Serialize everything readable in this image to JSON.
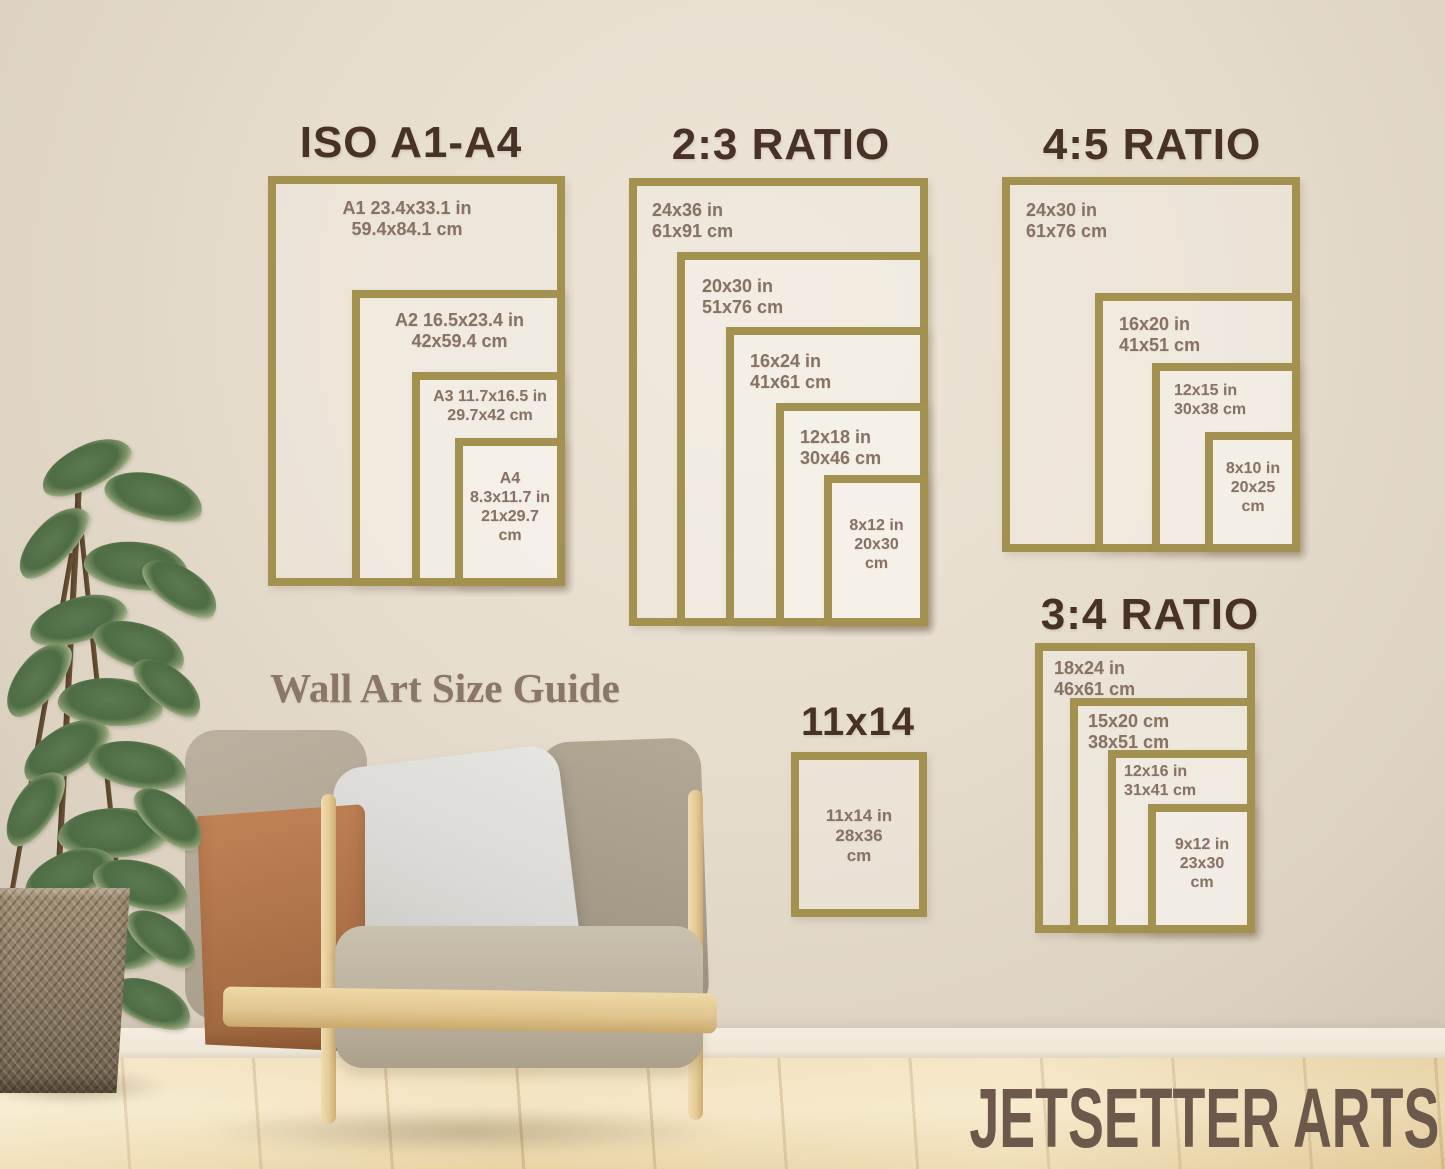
{
  "brand": {
    "watermark": "JETSETTER ARTS"
  },
  "caption": "Wall Art Size Guide",
  "colors": {
    "frame_gold": "#a3914f",
    "title_brown": "#483127",
    "label_brown": "#877264",
    "caption_brown": "#8b7767",
    "watermark_brown": "#6c594b",
    "wall_cream": "#e7decf",
    "floor_wood": "#eedcb4"
  },
  "sections": [
    {
      "title": "ISO A1-A4",
      "boxes": [
        {
          "name": "A1",
          "lines": [
            "A1 23.4x33.1 in",
            "59.4x84.1 cm"
          ]
        },
        {
          "name": "A2",
          "lines": [
            "A2 16.5x23.4 in",
            "42x59.4 cm"
          ]
        },
        {
          "name": "A3",
          "lines": [
            "A3 11.7x16.5 in",
            "29.7x42 cm"
          ]
        },
        {
          "name": "A4",
          "lines": [
            "A4",
            "8.3x11.7 in",
            "21x29.7",
            "cm"
          ]
        }
      ]
    },
    {
      "title": "2:3 RATIO",
      "boxes": [
        {
          "name": "24x36",
          "lines": [
            "24x36 in",
            "61x91 cm"
          ]
        },
        {
          "name": "20x30",
          "lines": [
            "20x30 in",
            "51x76 cm"
          ]
        },
        {
          "name": "16x24",
          "lines": [
            "16x24 in",
            "41x61 cm"
          ]
        },
        {
          "name": "12x18",
          "lines": [
            "12x18 in",
            "30x46 cm"
          ]
        },
        {
          "name": "8x12",
          "lines": [
            "8x12 in",
            "20x30",
            "cm"
          ]
        }
      ]
    },
    {
      "title": "4:5 RATIO",
      "boxes": [
        {
          "name": "24x30",
          "lines": [
            "24x30 in",
            "61x76 cm"
          ]
        },
        {
          "name": "16x20",
          "lines": [
            "16x20 in",
            "41x51 cm"
          ]
        },
        {
          "name": "12x15",
          "lines": [
            "12x15 in",
            "30x38 cm"
          ]
        },
        {
          "name": "8x10",
          "lines": [
            "8x10 in",
            "20x25",
            "cm"
          ]
        }
      ]
    },
    {
      "title": "3:4 RATIO",
      "boxes": [
        {
          "name": "18x24",
          "lines": [
            "18x24 in",
            "46x61 cm"
          ]
        },
        {
          "name": "15x20",
          "lines": [
            "15x20 cm",
            "38x51 cm"
          ]
        },
        {
          "name": "12x16",
          "lines": [
            "12x16 in",
            "31x41 cm"
          ]
        },
        {
          "name": "9x12",
          "lines": [
            "9x12 in",
            "23x30",
            "cm"
          ]
        }
      ]
    },
    {
      "title": "11x14",
      "boxes": [
        {
          "name": "11x14",
          "lines": [
            "11x14 in",
            "28x36",
            "cm"
          ]
        }
      ]
    }
  ]
}
